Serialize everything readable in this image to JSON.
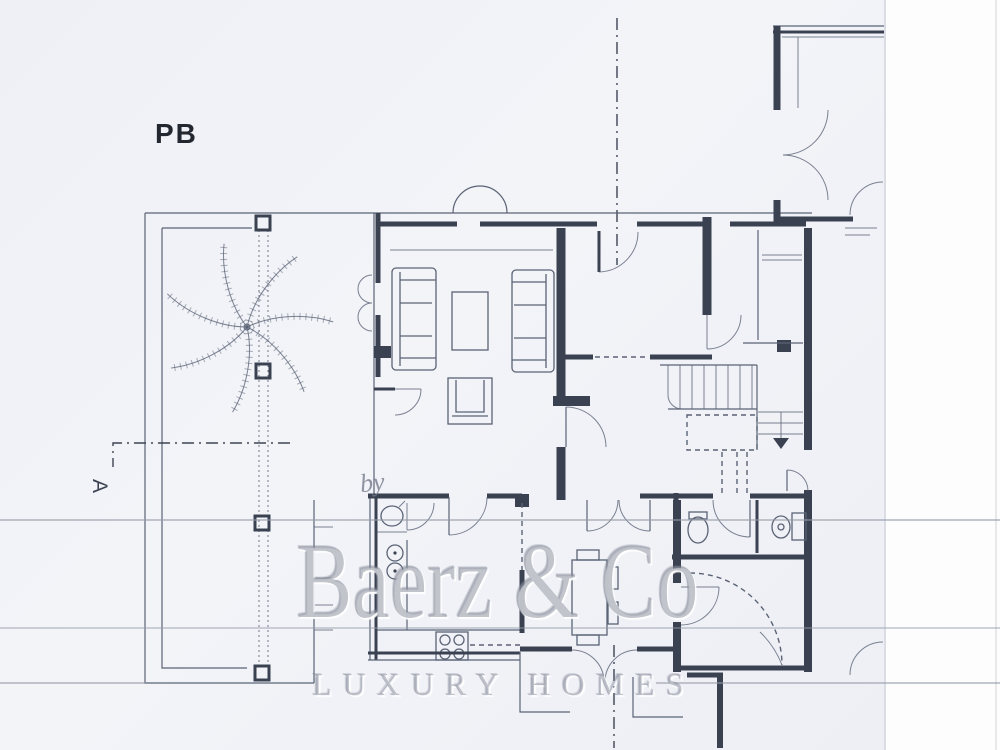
{
  "page": {
    "floor_label": "PB",
    "section_marker": "A"
  },
  "watermark": {
    "prefix": "by",
    "brand": "Baerz & Co",
    "tagline": "LUXURY HOMES"
  },
  "colors": {
    "wall": "#3a4252",
    "line": "#5a6375",
    "paper": "#f2f3f7",
    "watermark": "#8f95a5"
  }
}
